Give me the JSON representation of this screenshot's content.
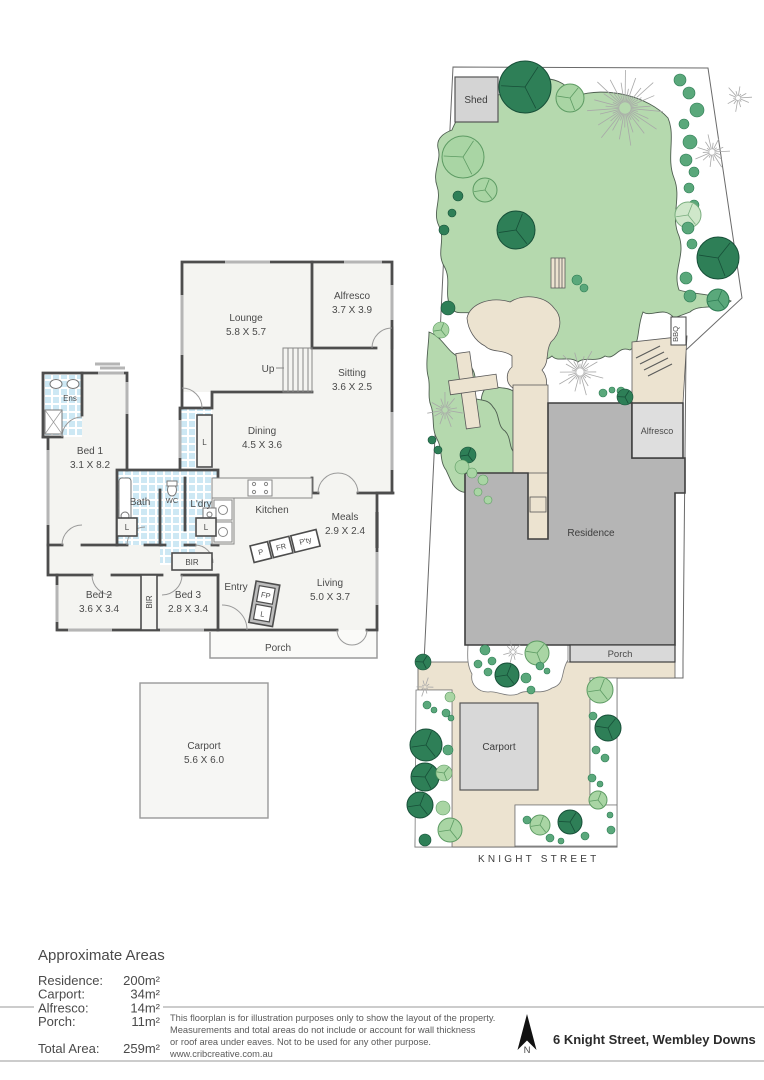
{
  "floorplan": {
    "lounge_name": "Lounge",
    "lounge_dims": "5.8 X 5.7",
    "alfresco_name": "Alfresco",
    "alfresco_dims": "3.7 X 3.9",
    "sitting_name": "Sitting",
    "sitting_dims": "3.6 X 2.5",
    "dining_name": "Dining",
    "dining_dims": "4.5 X 3.6",
    "bed1_name": "Bed 1",
    "bed1_dims": "3.1 X 8.2",
    "bed2_name": "Bed 2",
    "bed2_dims": "3.6 X 3.4",
    "bed3_name": "Bed 3",
    "bed3_dims": "2.8 X 3.4",
    "meals_name": "Meals",
    "meals_dims": "2.9 X 2.4",
    "living_name": "Living",
    "living_dims": "5.0 X 3.7",
    "carport_name": "Carport",
    "carport_dims": "5.6 X 6.0",
    "kitchen": "Kitchen",
    "bath": "Bath",
    "wc": "WC",
    "laundry": "L'dry",
    "ensuite": "Ens",
    "entry": "Entry",
    "porch": "Porch",
    "up": "Up",
    "fp": "FP",
    "linen": "L",
    "bir": "BIR",
    "pantry_p": "P",
    "fridge": "FR",
    "pantry": "P'ty"
  },
  "site": {
    "shed": "Shed",
    "bbq": "BBQ",
    "alfresco": "Alfresco",
    "residence": "Residence",
    "porch": "Porch",
    "carport": "Carport",
    "street": "KNIGHT STREET",
    "tree_colors": {
      "d": "#2e7f57",
      "m": "#5aa87b",
      "l": "#a9d5a4",
      "g": "#cfe7ca",
      "s": "#ffffff"
    },
    "trees": [
      [
        525,
        87,
        26,
        "d"
      ],
      [
        570,
        98,
        14,
        "l"
      ],
      [
        625,
        108,
        38,
        "s"
      ],
      [
        738,
        98,
        14,
        "s"
      ],
      [
        712,
        152,
        18,
        "s"
      ],
      [
        680,
        80,
        6,
        "m"
      ],
      [
        689,
        93,
        6,
        "m"
      ],
      [
        697,
        110,
        7,
        "m"
      ],
      [
        684,
        124,
        5,
        "m"
      ],
      [
        690,
        142,
        7,
        "m"
      ],
      [
        686,
        160,
        6,
        "m"
      ],
      [
        694,
        172,
        5,
        "m"
      ],
      [
        689,
        188,
        5,
        "m"
      ],
      [
        694,
        205,
        5,
        "m"
      ],
      [
        688,
        215,
        13,
        "g"
      ],
      [
        688,
        228,
        6,
        "m"
      ],
      [
        692,
        244,
        5,
        "m"
      ],
      [
        718,
        258,
        21,
        "d"
      ],
      [
        686,
        278,
        6,
        "m"
      ],
      [
        690,
        296,
        6,
        "m"
      ],
      [
        718,
        300,
        11,
        "m"
      ],
      [
        463,
        157,
        21,
        "l"
      ],
      [
        485,
        190,
        12,
        "l"
      ],
      [
        458,
        196,
        5,
        "d"
      ],
      [
        452,
        213,
        4,
        "d"
      ],
      [
        444,
        230,
        5,
        "d"
      ],
      [
        516,
        230,
        19,
        "d"
      ],
      [
        448,
        308,
        7,
        "d"
      ],
      [
        441,
        330,
        8,
        "l"
      ],
      [
        577,
        280,
        5,
        "m"
      ],
      [
        584,
        288,
        4,
        "m"
      ],
      [
        580,
        372,
        24,
        "s"
      ],
      [
        603,
        393,
        4,
        "m"
      ],
      [
        612,
        390,
        3,
        "m"
      ],
      [
        621,
        391,
        4,
        "m"
      ],
      [
        625,
        397,
        8,
        "d"
      ],
      [
        445,
        410,
        18,
        "s"
      ],
      [
        432,
        440,
        4,
        "d"
      ],
      [
        438,
        450,
        4,
        "d"
      ],
      [
        468,
        455,
        8,
        "d"
      ],
      [
        462,
        467,
        7,
        "l"
      ],
      [
        472,
        473,
        5,
        "l"
      ],
      [
        483,
        480,
        5,
        "l"
      ],
      [
        478,
        492,
        4,
        "l"
      ],
      [
        488,
        500,
        4,
        "l"
      ],
      [
        423,
        662,
        8,
        "d"
      ],
      [
        425,
        687,
        10,
        "s"
      ],
      [
        513,
        652,
        12,
        "s"
      ],
      [
        537,
        653,
        12,
        "l"
      ],
      [
        507,
        675,
        12,
        "d"
      ],
      [
        485,
        650,
        5,
        "m"
      ],
      [
        492,
        661,
        4,
        "m"
      ],
      [
        478,
        664,
        4,
        "m"
      ],
      [
        488,
        672,
        4,
        "m"
      ],
      [
        526,
        678,
        5,
        "m"
      ],
      [
        540,
        666,
        4,
        "m"
      ],
      [
        547,
        671,
        3,
        "m"
      ],
      [
        531,
        690,
        4,
        "m"
      ],
      [
        450,
        697,
        5,
        "l"
      ],
      [
        427,
        705,
        4,
        "m"
      ],
      [
        434,
        710,
        3,
        "m"
      ],
      [
        446,
        713,
        4,
        "m"
      ],
      [
        451,
        718,
        3,
        "m"
      ],
      [
        426,
        745,
        16,
        "d"
      ],
      [
        448,
        750,
        5,
        "m"
      ],
      [
        425,
        777,
        14,
        "d"
      ],
      [
        444,
        773,
        8,
        "l"
      ],
      [
        420,
        805,
        13,
        "d"
      ],
      [
        443,
        808,
        7,
        "l"
      ],
      [
        450,
        830,
        12,
        "l"
      ],
      [
        425,
        840,
        6,
        "d"
      ],
      [
        600,
        690,
        13,
        "l"
      ],
      [
        593,
        716,
        4,
        "m"
      ],
      [
        608,
        728,
        13,
        "d"
      ],
      [
        596,
        750,
        4,
        "m"
      ],
      [
        605,
        758,
        4,
        "m"
      ],
      [
        592,
        778,
        4,
        "m"
      ],
      [
        600,
        784,
        3,
        "m"
      ],
      [
        598,
        800,
        9,
        "l"
      ],
      [
        610,
        815,
        3,
        "m"
      ],
      [
        540,
        825,
        10,
        "l"
      ],
      [
        570,
        822,
        12,
        "d"
      ],
      [
        527,
        820,
        4,
        "m"
      ],
      [
        550,
        838,
        4,
        "m"
      ],
      [
        561,
        841,
        3,
        "m"
      ],
      [
        585,
        836,
        4,
        "m"
      ],
      [
        611,
        830,
        4,
        "m"
      ]
    ]
  },
  "areas": {
    "title": "Approximate Areas",
    "rows": [
      {
        "label": "Residence:",
        "value": "200m²"
      },
      {
        "label": "Carport:",
        "value": "34m²"
      },
      {
        "label": "Alfresco:",
        "value": "14m²"
      },
      {
        "label": "Porch:",
        "value": "11m²"
      }
    ],
    "total_label": "Total Area:",
    "total_value": "259m²"
  },
  "footer": {
    "disclaimer1": "This floorplan is for illustration purposes only to show the layout of the property.",
    "disclaimer2": "Measurements and total areas do not include or account for wall thickness",
    "disclaimer3": "or roof area under eaves. Not to be used for any other purpose.",
    "website": "www.cribcreative.com.au",
    "address": "6 Knight Street, Wembley Downs",
    "north": "N"
  }
}
